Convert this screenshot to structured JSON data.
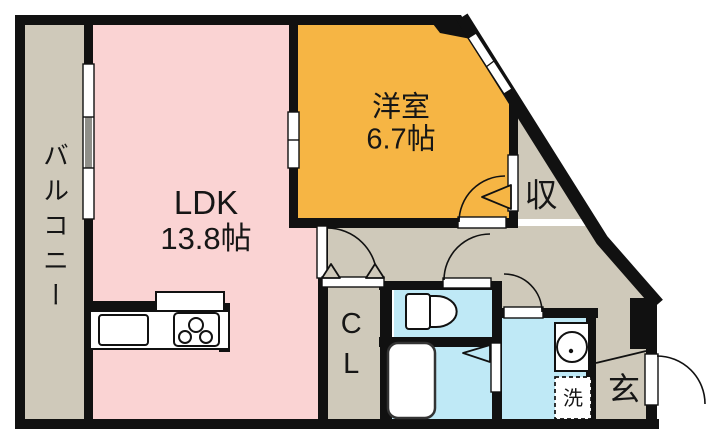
{
  "plan": {
    "rooms": {
      "balcony": {
        "label": "バルコニー"
      },
      "ldk": {
        "label": "LDK",
        "size": "13.8帖"
      },
      "western_room": {
        "label": "洋室",
        "size": "6.7帖"
      },
      "storage": {
        "label": "収"
      },
      "closet": {
        "label": "CL"
      },
      "entrance": {
        "label": "玄"
      },
      "washer": {
        "label": "洗"
      }
    }
  },
  "colors": {
    "background": "#ffffff",
    "wall": "#111111",
    "ldk": "#fad3d3",
    "western_room": "#f6b544",
    "wet_area": "#bfe9f6",
    "corridor": "#cfc9ba"
  }
}
